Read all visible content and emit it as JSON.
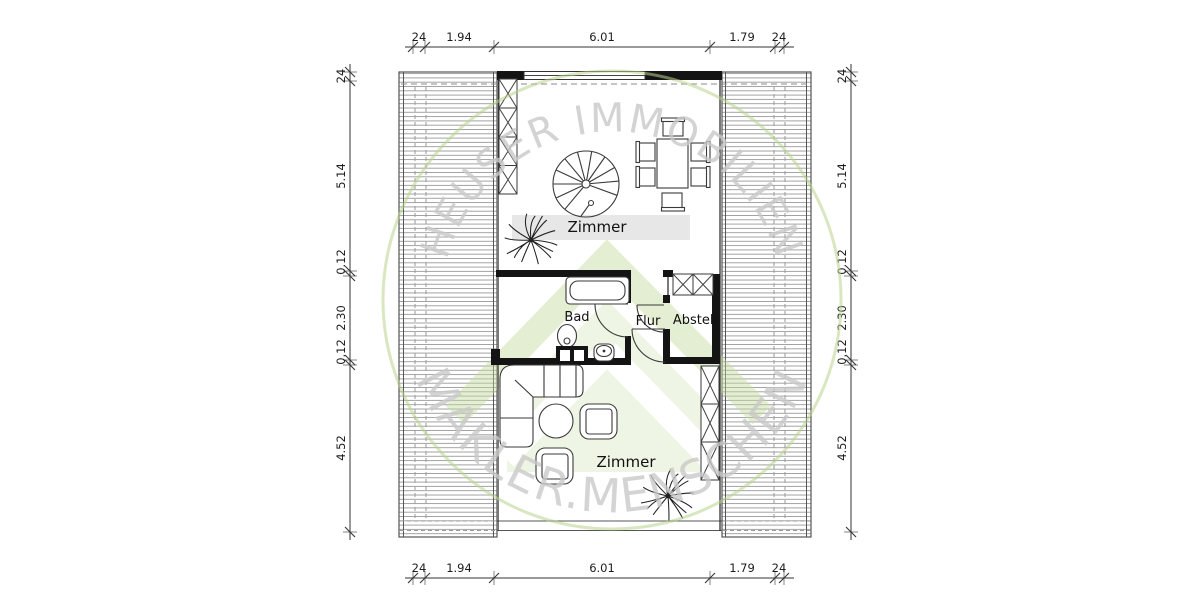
{
  "plan": {
    "rooms": [
      {
        "id": "zimmer_top",
        "label": "Zimmer"
      },
      {
        "id": "bad",
        "label": "Bad"
      },
      {
        "id": "flur",
        "label": "Flur"
      },
      {
        "id": "abstell",
        "label": "Abstell"
      },
      {
        "id": "zimmer_bottom",
        "label": "Zimmer"
      }
    ],
    "dimensions": {
      "top": [
        "24",
        "1.94",
        "6.01",
        "1.79",
        "24"
      ],
      "bottom": [
        "24",
        "1.94",
        "6.01",
        "1.79",
        "24"
      ],
      "left": [
        "24",
        "5.14",
        "0.12",
        "2.30",
        "0.12",
        "4.52"
      ],
      "right": [
        "24",
        "5.14",
        "0.12",
        "2.30",
        "0.12",
        "4.52"
      ]
    }
  },
  "watermark": {
    "arc_text_top": "HEUSER IMMOBILIEN",
    "arc_text_bottom": "MAKLER.MENSCHEN",
    "colors": {
      "ring": "#b9d48e",
      "logo_fill": "#dcebc4",
      "logo_stroke": "#c3db9c",
      "text": "#c9c9c9"
    }
  },
  "style": {
    "wall_color": "#141414",
    "line_color": "#3a3a3a",
    "hatch_color": "#9a9a9a",
    "band_color": "#e7e7e7",
    "background": "#ffffff"
  }
}
